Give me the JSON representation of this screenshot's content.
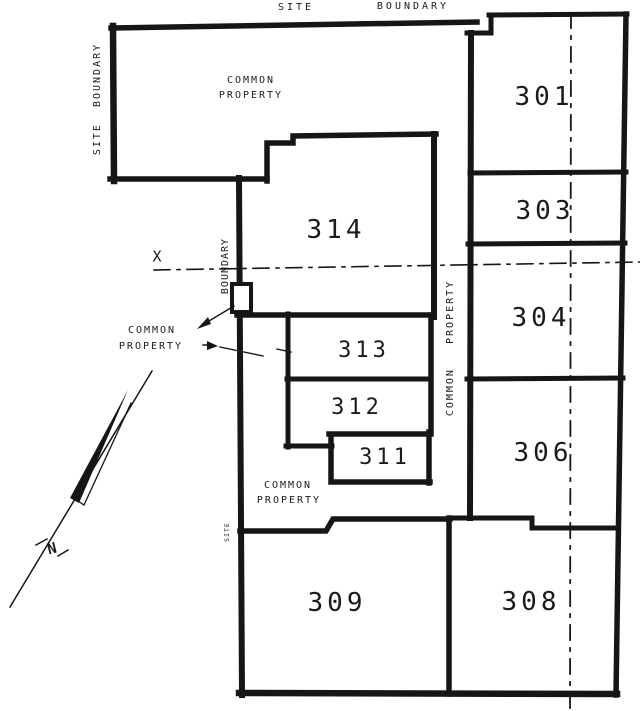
{
  "plan": {
    "site_boundary_top_word1": "SITE",
    "site_boundary_top_word2": "BOUNDARY",
    "site_boundary_left": "SITE  BOUNDARY",
    "common_property_top_line1": "COMMON",
    "common_property_top_line2": "PROPERTY",
    "boundary_vertical_label": "BOUNDARY",
    "x_marker": "X",
    "common_property_left_line1": "COMMON",
    "common_property_left_line2": "PROPERTY",
    "corridor_vertical_label": "COMMON   PROPERTY",
    "common_property_bottom_line1": "COMMON",
    "common_property_bottom_line2": "PROPERTY",
    "site_small_vertical": "SITE",
    "north_label": "N"
  },
  "lots": [
    {
      "id": "301"
    },
    {
      "id": "303"
    },
    {
      "id": "304"
    },
    {
      "id": "306"
    },
    {
      "id": "308"
    },
    {
      "id": "309"
    },
    {
      "id": "311"
    },
    {
      "id": "312"
    },
    {
      "id": "313"
    },
    {
      "id": "314"
    }
  ],
  "colors": {
    "ink": "#1b1b1b",
    "paper": "#ffffff"
  }
}
